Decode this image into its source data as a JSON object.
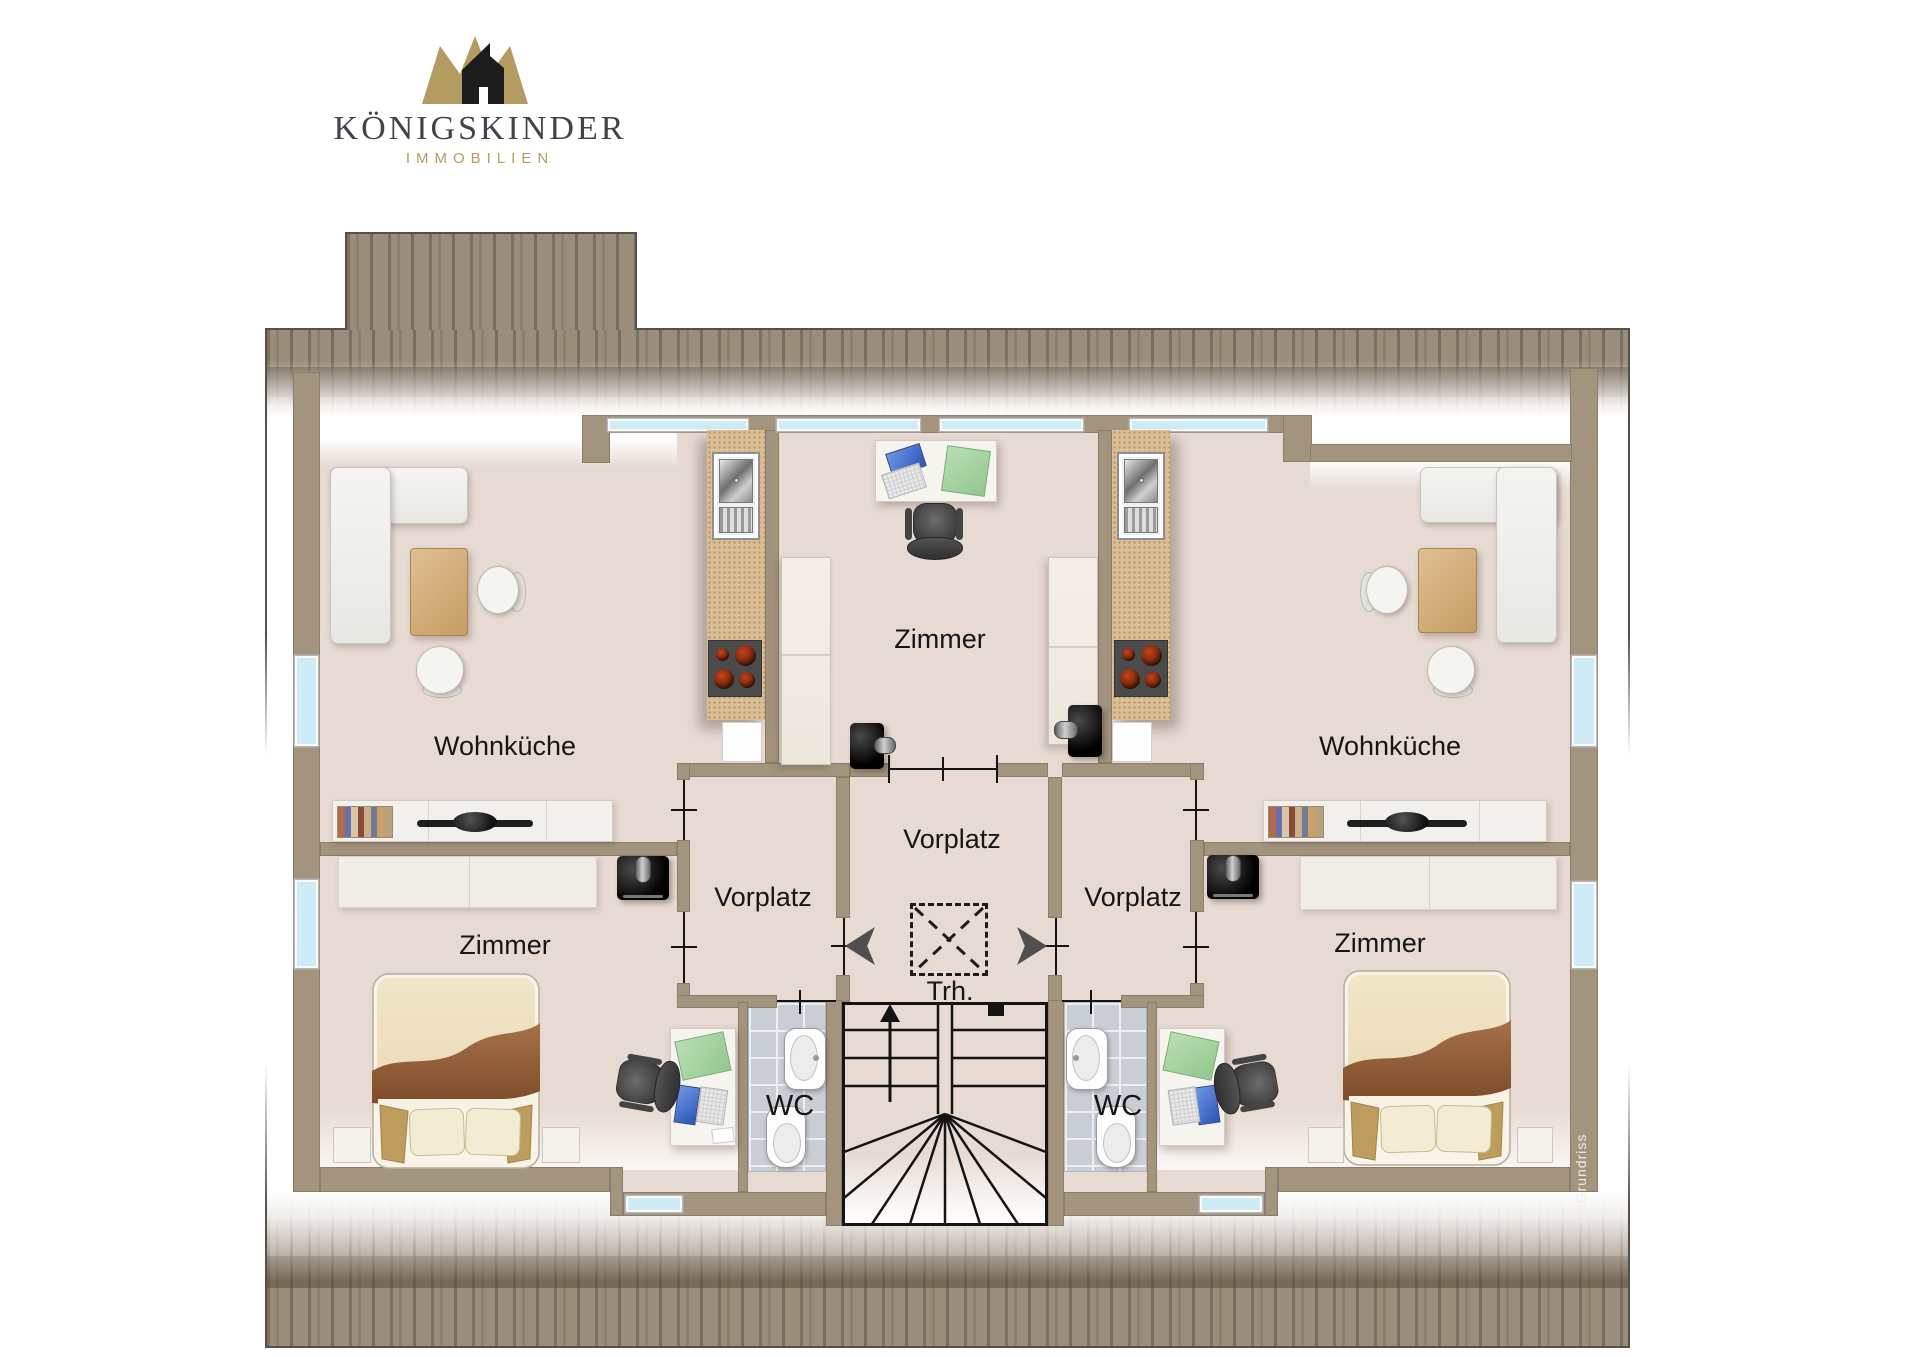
{
  "brand": {
    "name": "KÖNIGSKINDER",
    "subtitle": "IMMOBILIEN",
    "logo_icon": "crown-house-icon",
    "colors": {
      "gold": "#b49b62",
      "text": "#41454b",
      "black": "#1a1a1a"
    }
  },
  "plan": {
    "watermark": "McGrundriss",
    "labels": {
      "wohnkueche_left": "Wohnküche",
      "zimmer_center": "Zimmer",
      "wohnkueche_right": "Wohnküche",
      "vorplatz_left": "Vorplatz",
      "vorplatz_center": "Vorplatz",
      "vorplatz_right": "Vorplatz",
      "zimmer_bottom_left": "Zimmer",
      "zimmer_bottom_right": "Zimmer",
      "treppenhaus": "Trh.",
      "wc_left": "WC",
      "wc_right": "WC"
    },
    "icons": {
      "entry_left": "arrow-left-icon",
      "entry_right": "arrow-right-icon",
      "stairs_direction": "arrow-up-icon",
      "skylight": "dashed-x-box"
    },
    "colors": {
      "floor": "#e7dad3",
      "wall": "#a3947e",
      "outline": "#57504a",
      "window": "#cdecf6",
      "kitchen_counter": "#dcbe94",
      "wc_tiles": "#c9cdd4",
      "label_text": "#161616"
    }
  }
}
